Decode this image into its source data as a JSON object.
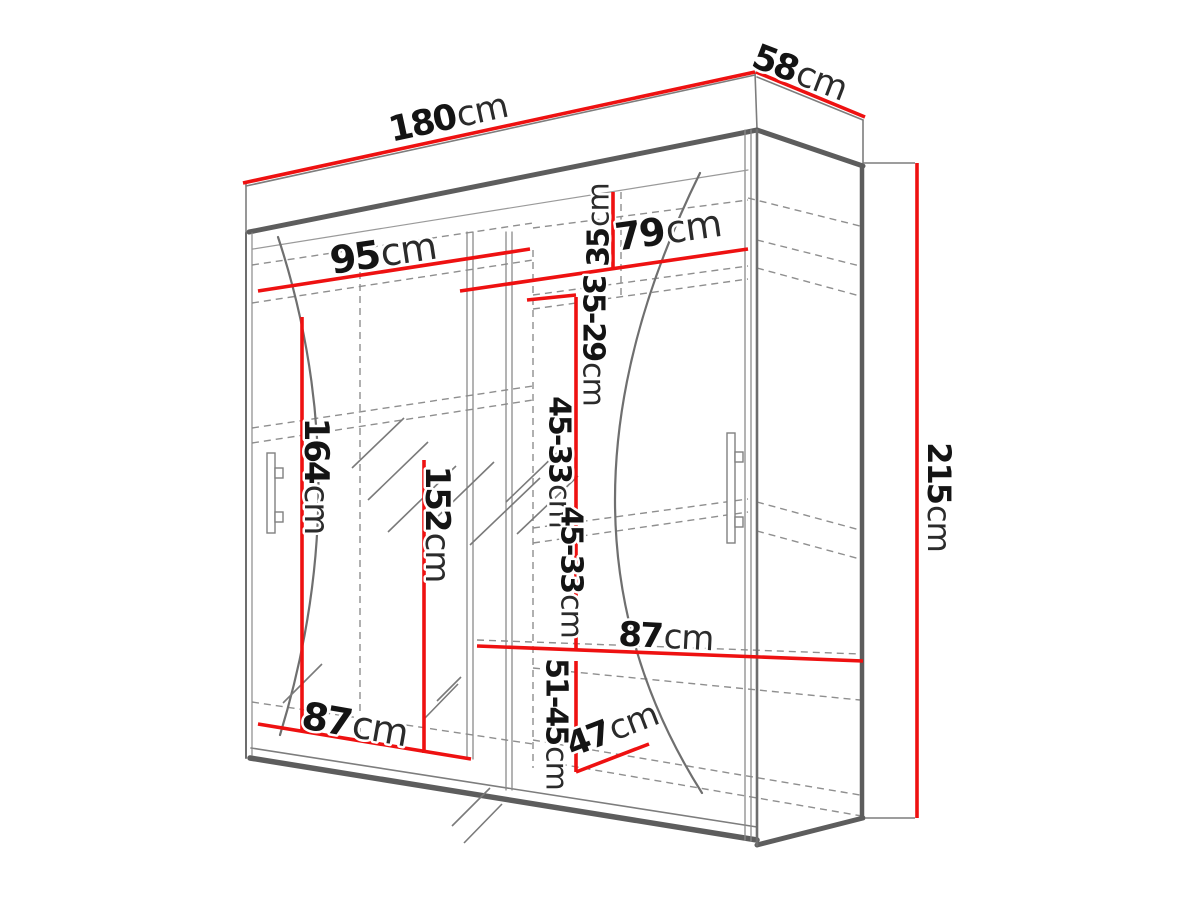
{
  "diagram": {
    "kind": "wardrobe dimension drawing",
    "unit": "cm",
    "accent_color": "#ee1111",
    "outline_color": "#5d5d5d",
    "dims": {
      "width": {
        "value": "180",
        "unit": "cm"
      },
      "depth": {
        "value": "58",
        "unit": "cm"
      },
      "height": {
        "value": "215",
        "unit": "cm"
      },
      "left_section_width": {
        "value": "95",
        "unit": "cm"
      },
      "right_section_width": {
        "value": "79",
        "unit": "cm"
      },
      "top_shelf_drop": {
        "value": "35",
        "unit": "cm"
      },
      "shelf_gap_upper": {
        "value": "35-29",
        "unit": "cm"
      },
      "shelf_gap_middle": {
        "value": "45-33",
        "unit": "cm"
      },
      "shelf_gap_lower": {
        "value": "45-33",
        "unit": "cm"
      },
      "bottom_shelf_gap": {
        "value": "51-45",
        "unit": "cm"
      },
      "left_interior_height": {
        "value": "164",
        "unit": "cm"
      },
      "hanging_height": {
        "value": "152",
        "unit": "cm"
      },
      "right_shelf_width": {
        "value": "87",
        "unit": "cm"
      },
      "bottom_shelf_width": {
        "value": "87",
        "unit": "cm"
      },
      "interior_depth": {
        "value": "47",
        "unit": "cm"
      }
    }
  }
}
